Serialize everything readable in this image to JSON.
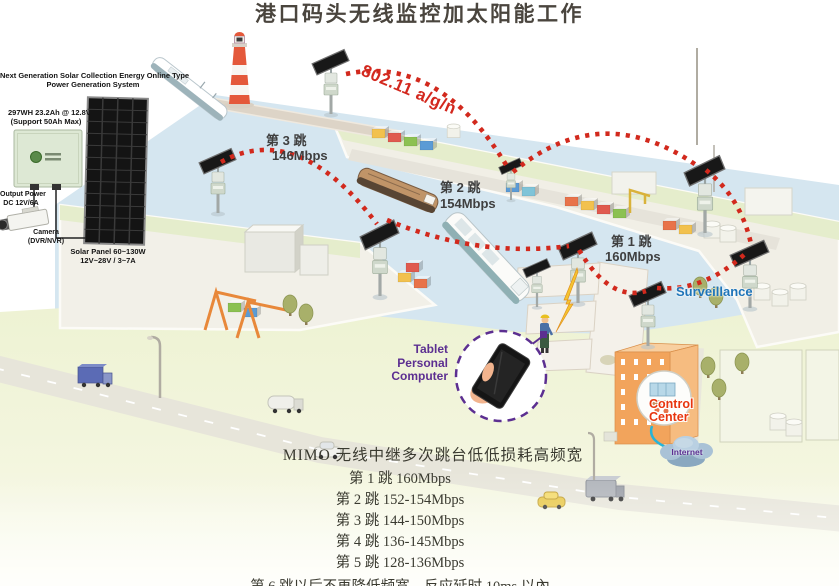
{
  "title": "港口码头无线监控加太阳能工作",
  "inset": {
    "header_line1": "Next Generation Solar Collection Energy Online Type",
    "header_line2": "Power Generation System",
    "battery_line1": "297WH 23.2Ah @ 12.8V",
    "battery_line2": "(Support 50Ah Max)",
    "output_line1": "Output Power",
    "output_line2": "DC 12V/6A",
    "camera_line1": "Camera",
    "camera_line2": "(DVR/NVR)",
    "panel_line1": "Solar Panel 60~130W",
    "panel_line2": "12V~28V / 3~7A"
  },
  "scene": {
    "wireless_standard": "802.11 a/g/n",
    "hop1_name": "第 1 跳",
    "hop1_rate": "160Mbps",
    "hop2_name": "第 2 跳",
    "hop2_rate": "154Mbps",
    "hop3_name": "第 3 跳",
    "hop3_rate": "146Mbps",
    "surveillance": "Surveillance",
    "tablet_line1": "Tablet",
    "tablet_line2": "Personal",
    "tablet_line3": "Computer",
    "control_line1": "Control",
    "control_line2": "Center",
    "internet": "Internet"
  },
  "legend": {
    "heading": "MIMO 无线中继多次跳台低低损耗高频宽",
    "rows": [
      "第 1 跳 160Mbps",
      "第 2 跳 152-154Mbps",
      "第 3 跳 144-150Mbps",
      "第 4 跳 136-145Mbps",
      "第 5 跳 128-136Mbps"
    ],
    "footnote": "第 6 跳以后不再降低频宽，反应延时 10ms 以內"
  },
  "colors": {
    "signal_red": "#d3281e",
    "surveillance_blue": "#1e74b8",
    "tablet_purple": "#5c2f91",
    "control_red": "#e8350e",
    "water": "#d5e6f0",
    "land": "#edf2d2"
  }
}
